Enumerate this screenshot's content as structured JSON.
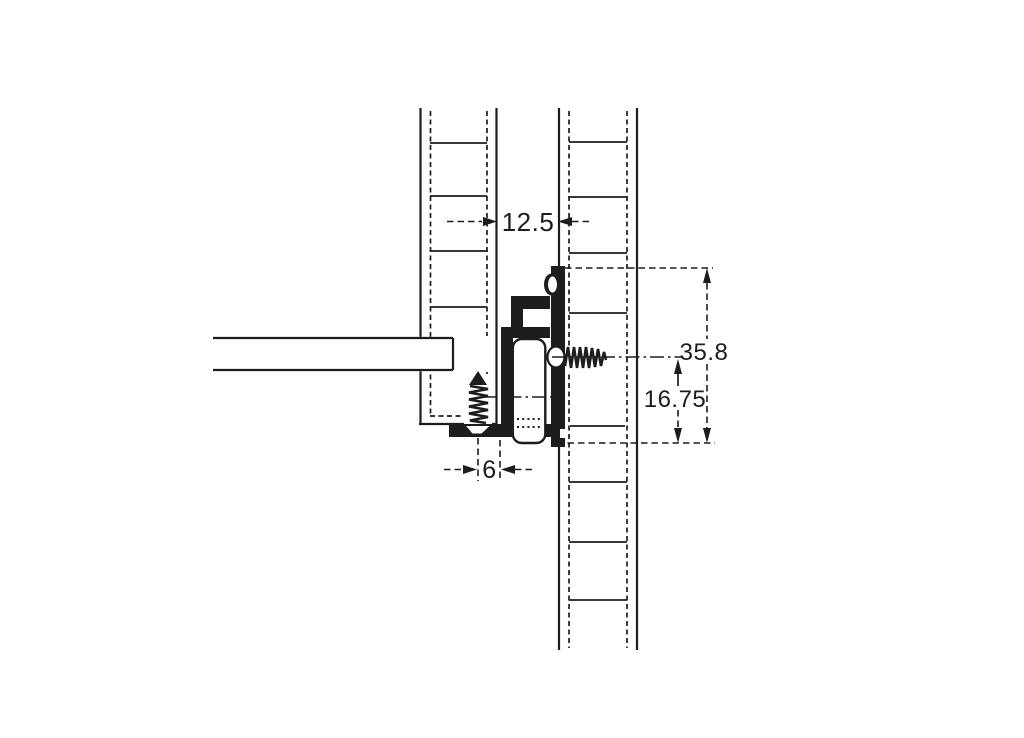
{
  "dimensions": {
    "panel_gap": "12.5",
    "overall_height": "35.8",
    "center_to_bottom": "16.75",
    "screw_offset": "6"
  },
  "colors": {
    "line": "#1d1d1d",
    "background": "#ffffff"
  }
}
